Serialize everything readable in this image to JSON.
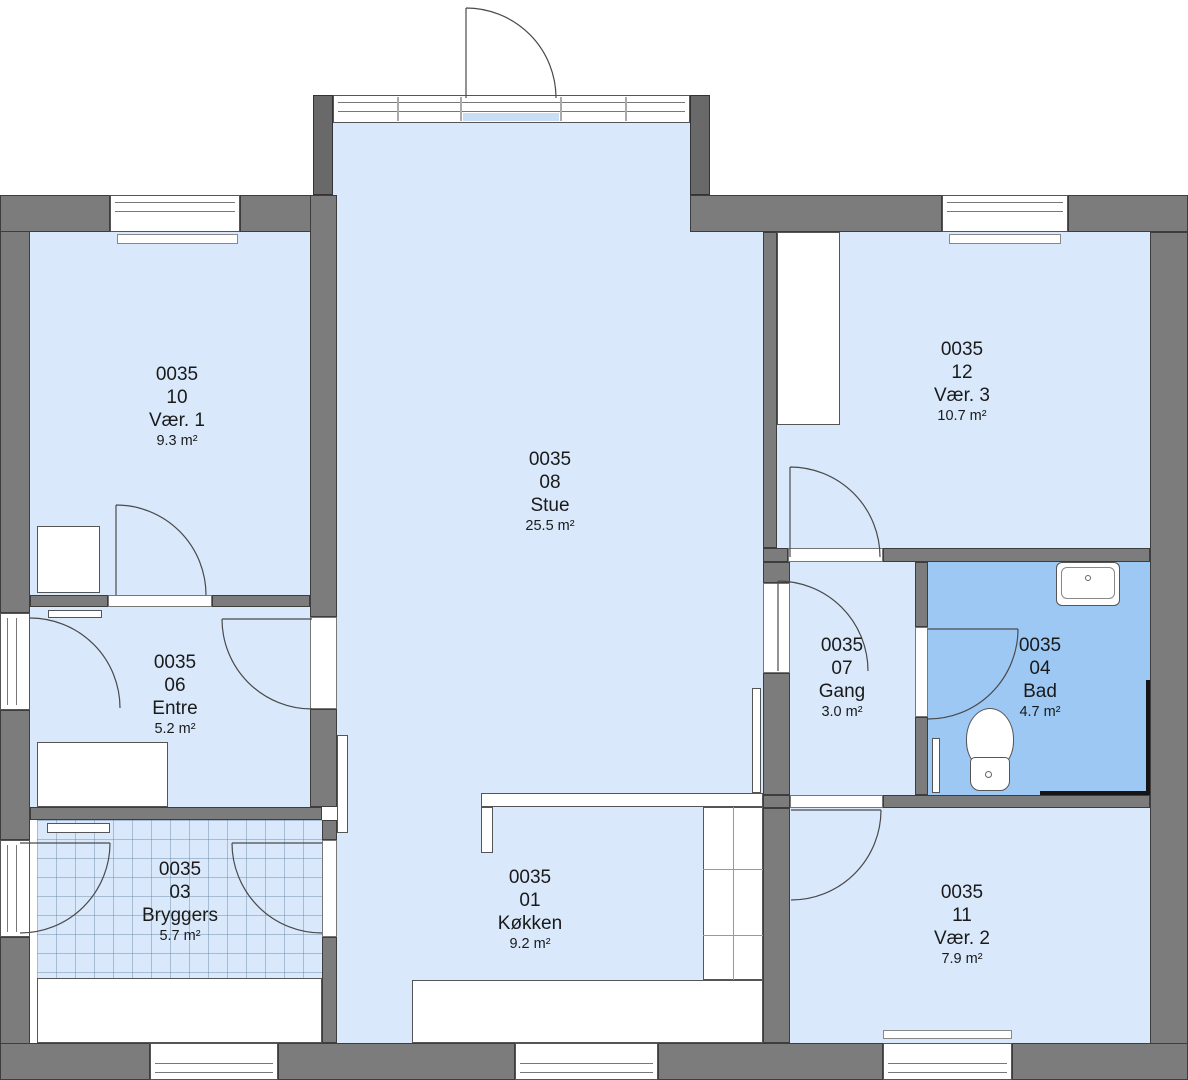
{
  "plan": {
    "building_code": "0035",
    "rooms": [
      {
        "id": "0035",
        "number": "10",
        "name": "Vær. 1",
        "area": "9.3 m²"
      },
      {
        "id": "0035",
        "number": "08",
        "name": "Stue",
        "area": "25.5 m²"
      },
      {
        "id": "0035",
        "number": "12",
        "name": "Vær. 3",
        "area": "10.7 m²"
      },
      {
        "id": "0035",
        "number": "06",
        "name": "Entre",
        "area": "5.2 m²"
      },
      {
        "id": "0035",
        "number": "07",
        "name": "Gang",
        "area": "3.0 m²"
      },
      {
        "id": "0035",
        "number": "04",
        "name": "Bad",
        "area": "4.7 m²"
      },
      {
        "id": "0035",
        "number": "03",
        "name": "Bryggers",
        "area": "5.7 m²"
      },
      {
        "id": "0035",
        "number": "01",
        "name": "Køkken",
        "area": "9.2 m²"
      },
      {
        "id": "0035",
        "number": "11",
        "name": "Vær. 2",
        "area": "7.9 m²"
      }
    ],
    "colors": {
      "wall": "#7c7c7c",
      "room_fill": "#d9e9fb",
      "wet_room_fill": "#9cc8f3",
      "fixture_fill": "#ffffff",
      "outline": "#3d3d3d"
    }
  }
}
